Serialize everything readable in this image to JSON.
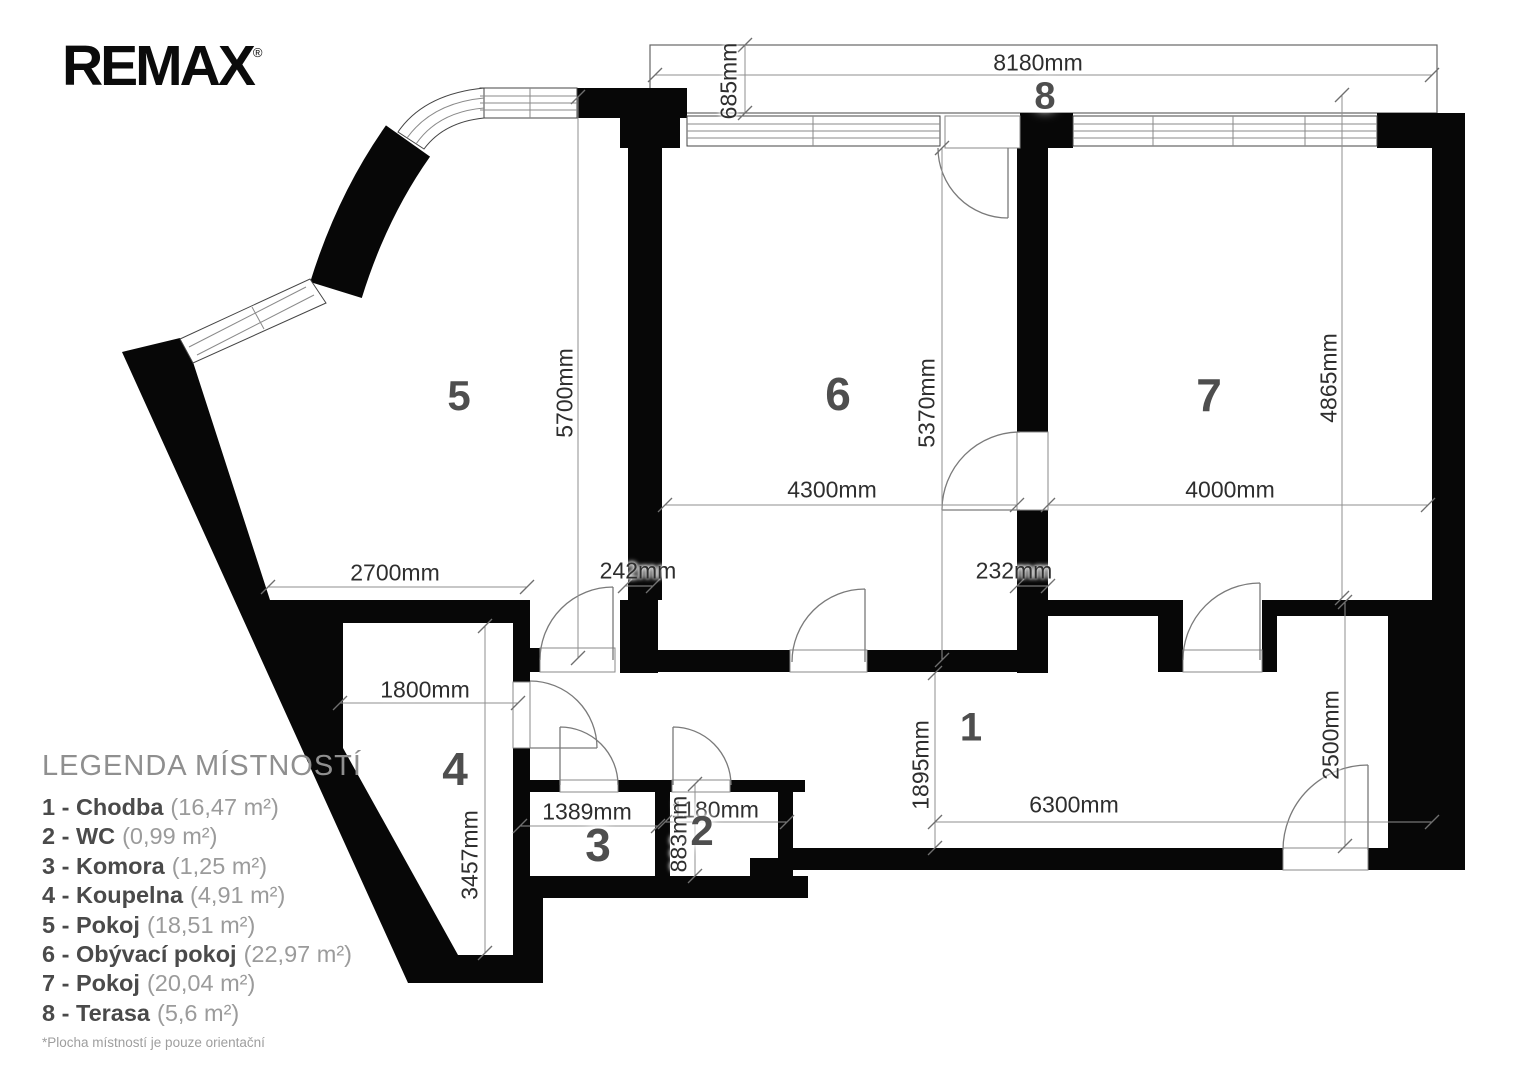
{
  "logo": {
    "text": "REMAX",
    "registered": "®"
  },
  "plan": {
    "room_numbers": {
      "r1": "1",
      "r2": "2",
      "r3": "3",
      "r4": "4",
      "r5": "5",
      "r6": "6",
      "r7": "7",
      "r8": "8"
    },
    "dimensions": {
      "terrace_width": "8180mm",
      "terrace_depth": "685mm",
      "room5_height": "5700mm",
      "room6_width": "4300mm",
      "room6_height": "5370mm",
      "room7_width": "4000mm",
      "room7_height": "4865mm",
      "room5_width": "2700mm",
      "pier_56": "242mm",
      "pier_67": "232mm",
      "room4_width": "1800mm",
      "room4_height": "3457mm",
      "room3_width": "1389mm",
      "room2_width": "1180mm",
      "room2_height": "883mm",
      "hall_height": "1895mm",
      "hall_width": "6300mm",
      "hall_entry_height": "2500mm"
    }
  },
  "legend": {
    "title": "LEGENDA MÍSTNOSTÍ",
    "items": [
      {
        "label": "1 - Chodba",
        "area": "(16,47 m²)"
      },
      {
        "label": "2 - WC",
        "area": "(0,99 m²)"
      },
      {
        "label": "3 - Komora",
        "area": "(1,25 m²)"
      },
      {
        "label": "4 - Koupelna",
        "area": "(4,91 m²)"
      },
      {
        "label": "5 - Pokoj",
        "area": "(18,51 m²)"
      },
      {
        "label": "6 - Obývací pokoj",
        "area": "(22,97 m²)"
      },
      {
        "label": "7 - Pokoj",
        "area": "(20,04 m²)"
      },
      {
        "label": "8 - Terasa",
        "area": "(5,6 m²)"
      }
    ],
    "footnote": "*Plocha místností je pouze orientační"
  }
}
